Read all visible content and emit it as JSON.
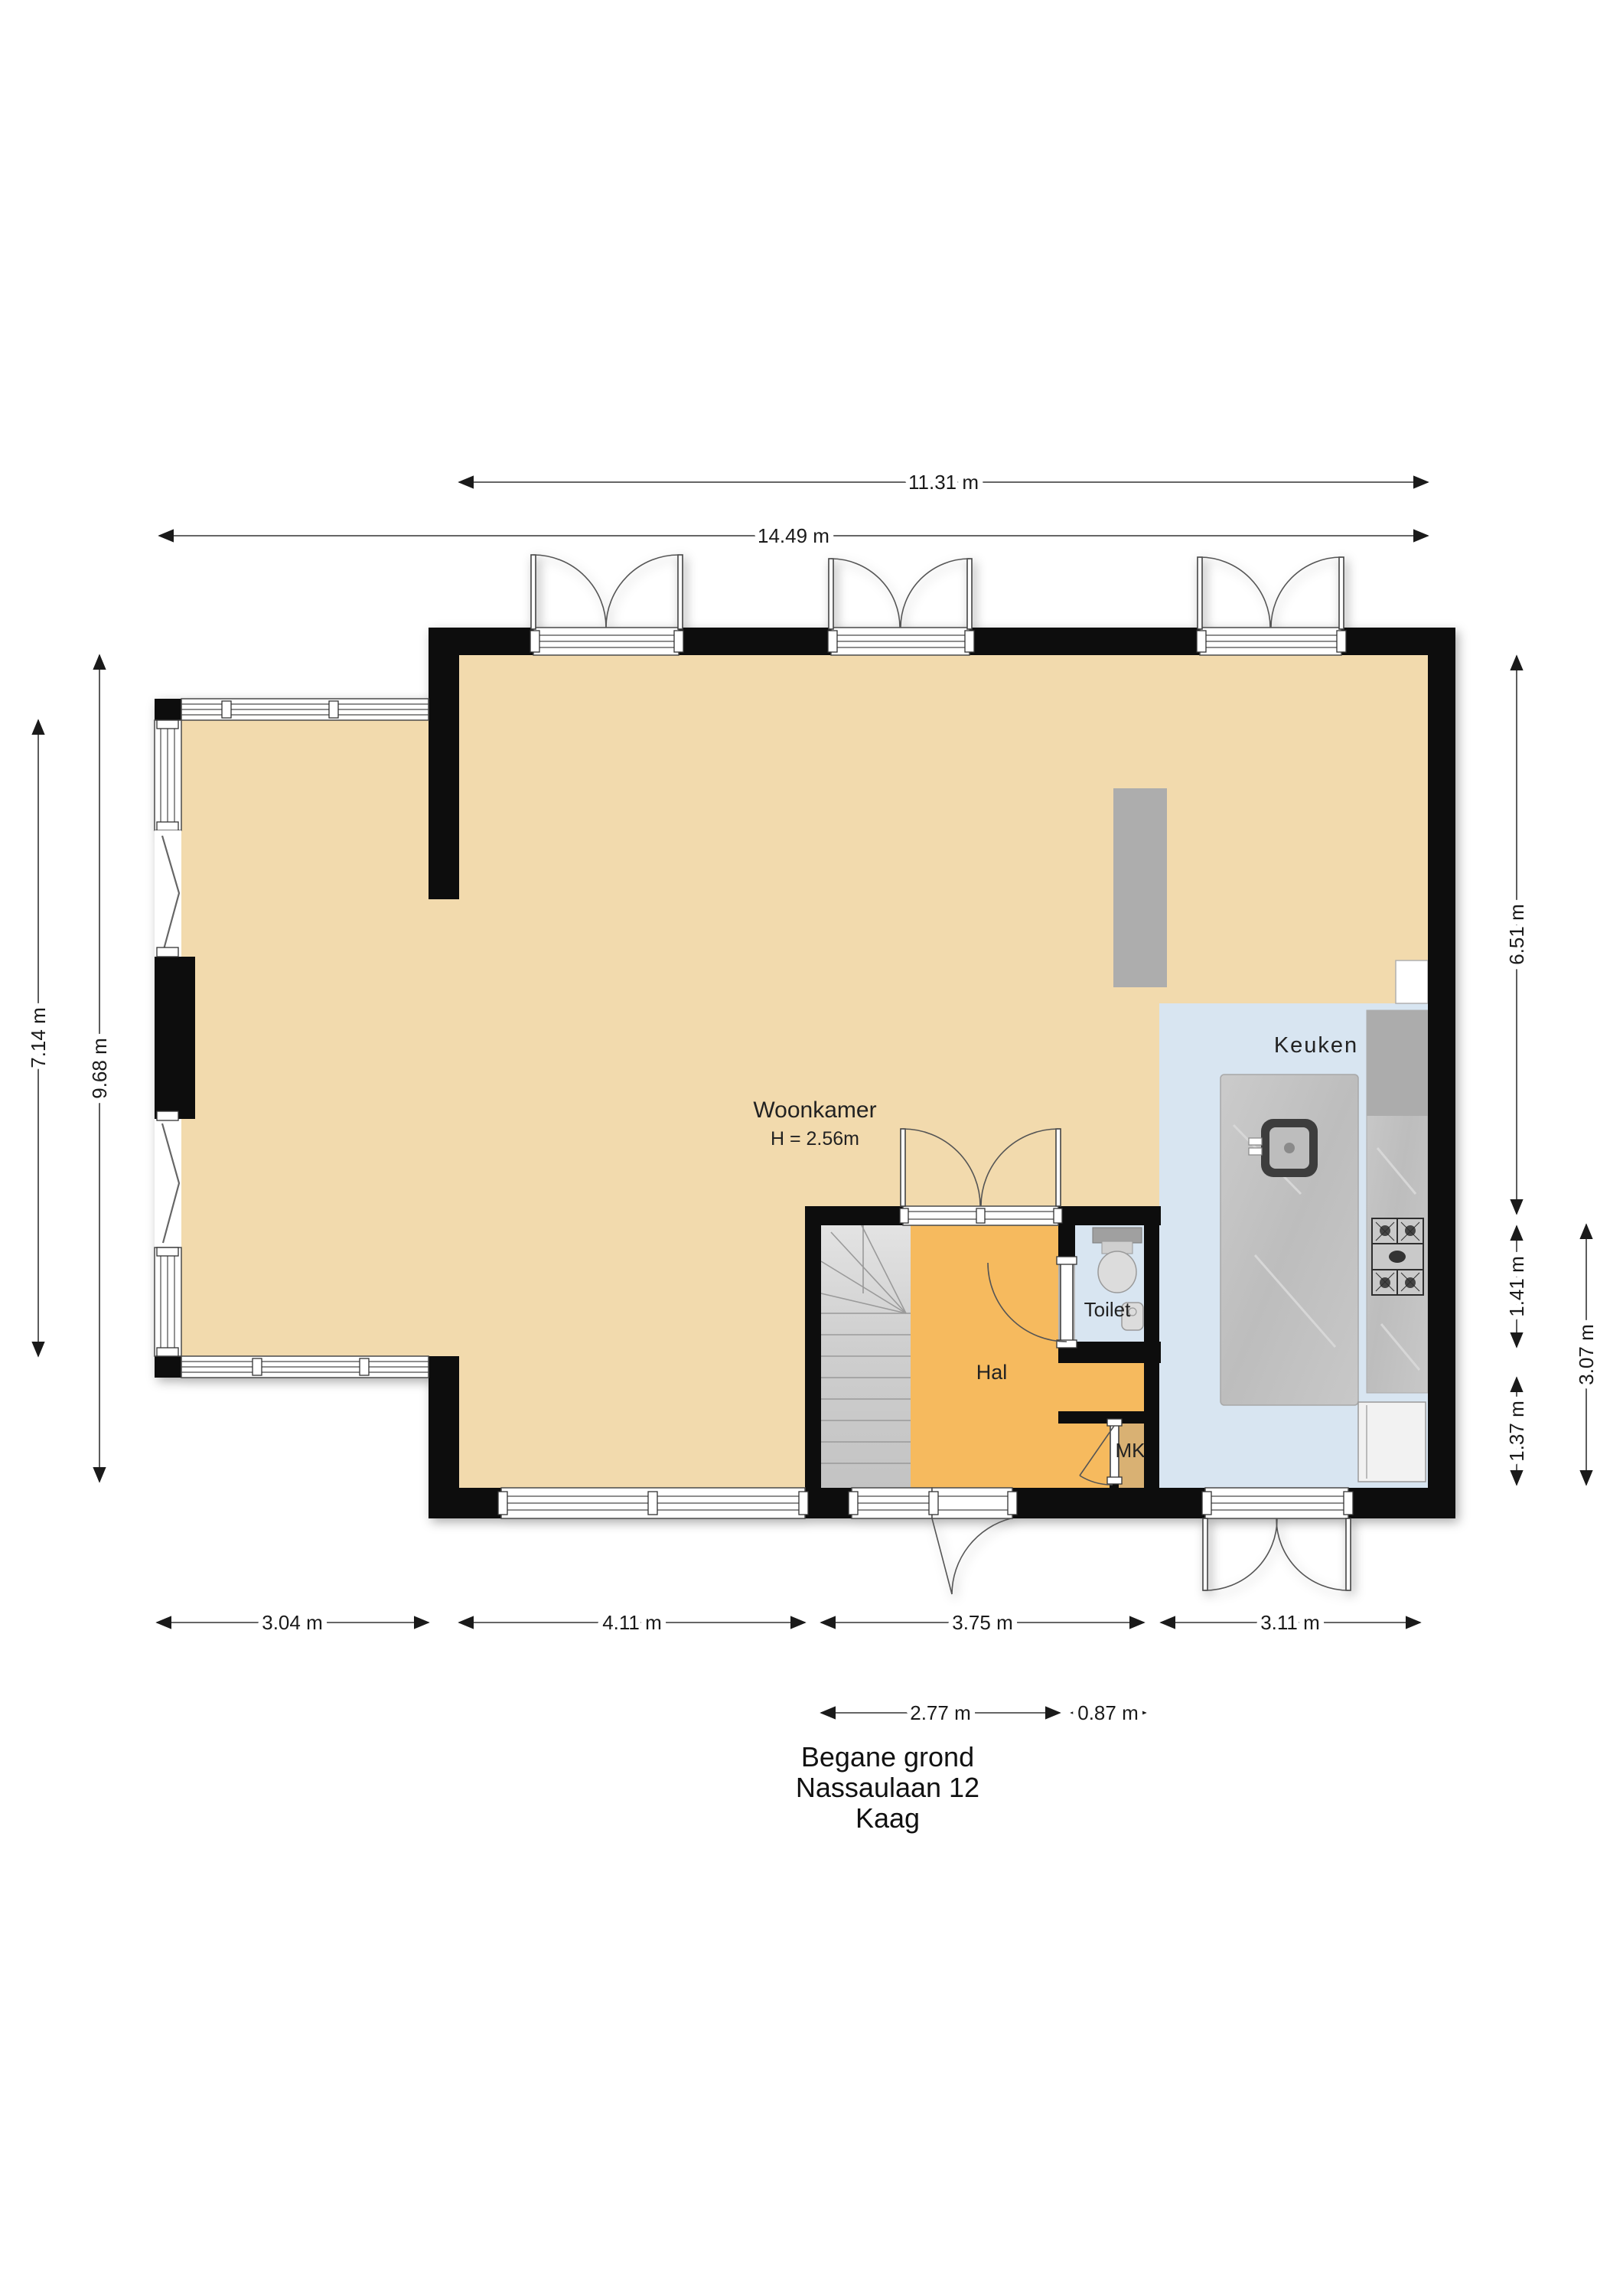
{
  "title": {
    "line1": "Begane grond",
    "line2": "Nassaulaan 12",
    "line3": "Kaag"
  },
  "rooms": {
    "woonkamer": {
      "label": "Woonkamer",
      "ceiling_note": "H = 2.56m"
    },
    "keuken": {
      "label": "Keuken"
    },
    "hal": {
      "label": "Hal"
    },
    "toilet": {
      "label": "Toilet"
    },
    "mk": {
      "label": "MK"
    }
  },
  "dimensions": {
    "top": [
      "11.31 m",
      "14.49 m"
    ],
    "left": [
      "7.14 m",
      "9.68 m"
    ],
    "right": [
      "6.51 m",
      "1.41 m",
      "1.37 m",
      "3.07 m"
    ],
    "bottom_row1": [
      "3.04 m",
      "4.11 m",
      "3.75 m",
      "3.11 m"
    ],
    "bottom_row2": [
      "2.77 m",
      "0.87 m"
    ]
  },
  "colors": {
    "wall": "#0d0d0d",
    "floor_living": "#F2DAAD",
    "floor_hall": "#F6BA5E",
    "floor_kitchen": "#D8E5F1",
    "floor_toilet": "#D8E5F1",
    "floor_mk": "#D9B173",
    "stairs": "#D8D8D8",
    "counter": "#C4C4C4",
    "counter_block": "#ACACAC",
    "closet_block": "#ADADAD"
  }
}
